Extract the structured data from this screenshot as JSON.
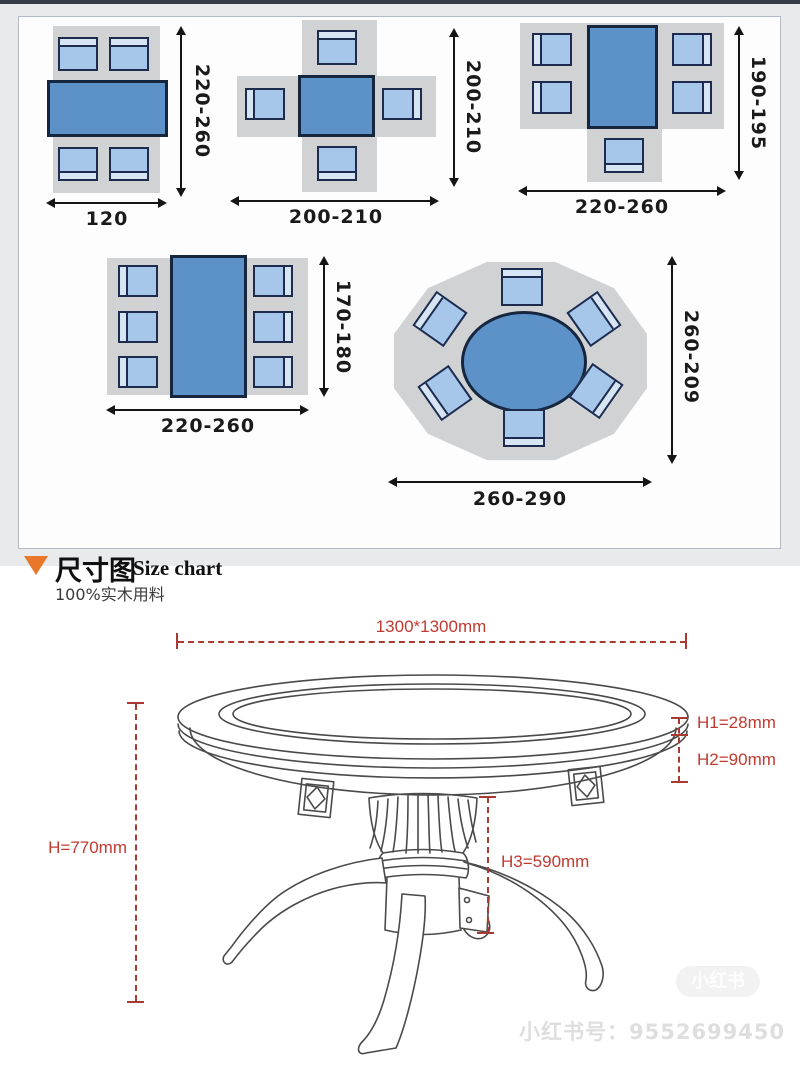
{
  "top_panel": {
    "description": "dining table clearance layout diagrams (top view)",
    "diagrams": [
      {
        "type": "rect-table-4-chairs",
        "label_bottom": "120",
        "label_side": "220-260"
      },
      {
        "type": "square-table-4-chairs",
        "label_bottom": "200-210",
        "label_side": "200-210"
      },
      {
        "type": "rect-table-5-chairs",
        "label_bottom": "220-260",
        "label_side": "190-195"
      },
      {
        "type": "rect-table-6-chairs",
        "label_bottom": "220-260",
        "label_side": "170-180"
      },
      {
        "type": "round-table-6-chairs",
        "label_bottom": "260-290",
        "label_side": "260-209"
      }
    ]
  },
  "size_chart": {
    "title_zh": "尺寸图",
    "title_en": "Size chart",
    "subtitle": "100%实木用料",
    "dim_top": "1300*1300mm",
    "dim_h": "H=770mm",
    "dim_h1": "H1=28mm",
    "dim_h2": "H2=90mm",
    "dim_h3": "H3=590mm"
  },
  "watermark": {
    "logo": "小红书",
    "id_text": "小红书号：9552699450"
  },
  "colors": {
    "table_fill": "#5d92c9",
    "chair_fill": "#a6c7e9",
    "rug_gray": "#d1d2d4",
    "dim_red": "#a93a32",
    "accent_orange": "#e8772b"
  }
}
